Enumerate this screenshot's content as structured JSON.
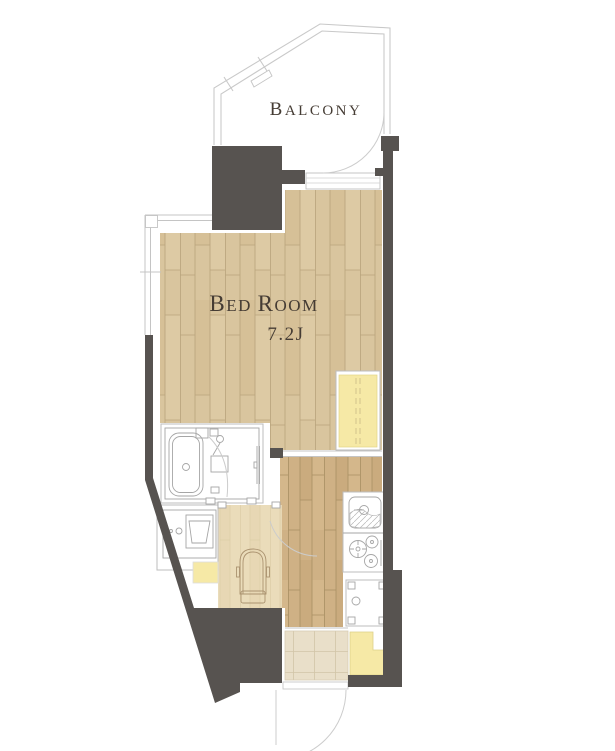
{
  "plan": {
    "balcony_label": {
      "initial": "B",
      "rest": "ALCONY"
    },
    "bedroom_label": {
      "b": "B",
      "ed": "ED ",
      "r": "R",
      "oom": "OOM"
    },
    "bedroom_size": "7.2J"
  },
  "colors": {
    "wall": "#575350",
    "wood_main": "#d9c59e",
    "wood_main_seam": "#b9a47c",
    "wood_hall": "#cfb185",
    "wood_hall_seam": "#a98f63",
    "wood_light": "#eadcba",
    "wood_light_seam": "#dccda6",
    "tile": "#e9dfc9",
    "tile_line": "#d2c5a8",
    "closet_yellow": "#f6e9a6"
  },
  "fixtures": [
    "bathtub",
    "shower-door",
    "vanity-sink",
    "toilet",
    "kitchen-sink",
    "gas-stove",
    "washer-pan",
    "closet",
    "shoe-cabinet",
    "entrance-tile",
    "balcony-railing",
    "bedroom-window"
  ]
}
